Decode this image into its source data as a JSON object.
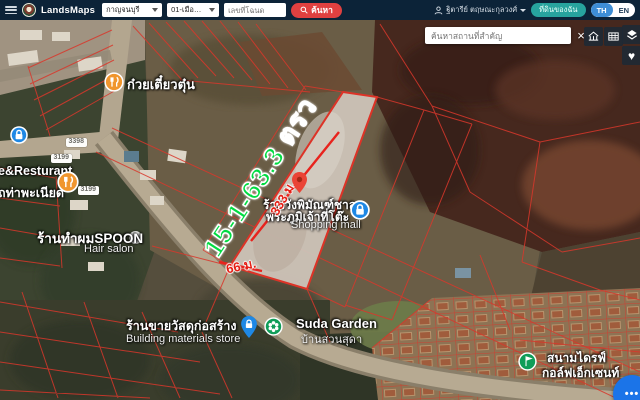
{
  "header": {
    "brand": "LandsMaps",
    "province": "กาญจนบุรี",
    "district": "01-เมืองกาญจนบุรี",
    "deed_placeholder": "เลขที่โฉนด",
    "search_label": "ค้นหา",
    "user_name": "ฐิตารีย์ ตฤษณะกุลวงศ์",
    "my_land_label": "ที่ดินของฉัน",
    "lang_th": "TH",
    "lang_en": "EN"
  },
  "map": {
    "place_search_placeholder": "ค้นหาสถานที่สำคัญ",
    "parcel": {
      "area": "15-1-63.3 ตรว",
      "length": "333 ม.",
      "width": "66 ม."
    },
    "road_badges": [
      {
        "label": "3398"
      },
      {
        "label": "3199"
      },
      {
        "label": "3199"
      }
    ],
    "pois": {
      "noodle_shop": "ก๋วยเตี๋ยวตุ๋น",
      "restaurant_en": "e&Resturant",
      "restaurant_th": "ถท่าพะเนียด",
      "hair_salon": "ร้านทำผมSPOON",
      "hair_salon_en": "Hair salon",
      "print_shop_line1": "ร้านวังพิมัณฑ์ชาล",
      "print_shop_line2": "พระภูมิเจ้าที่โต๊ะ",
      "shopping_mall": "Shopping mall",
      "building_store": "ร้านขายวัสดุก่อสร้าง",
      "building_store_en": "Building materials store",
      "suda_garden": "Suda Garden",
      "suda_garden_th": "บ้านสวนสุดา",
      "golf_line1": "สนามไดรฟ์",
      "golf_line2": "กอล์ฟเอ็กเซนท์"
    }
  },
  "icons": {
    "close": "×",
    "heart": "♥",
    "dots": "•••"
  },
  "colors": {
    "topbar": "#0c2338",
    "accent_red": "#e04040",
    "teal": "#27a39e",
    "lang_active": "#3e8ed6",
    "cadastral_red": "#d8372b",
    "parcel_area_green": "#00dc41",
    "measure_red": "#e51f15",
    "marker_blue": "#1e88e5",
    "marker_orange": "#f0962e",
    "marker_green": "#0f9d58",
    "fab_blue": "#1b74e8"
  }
}
